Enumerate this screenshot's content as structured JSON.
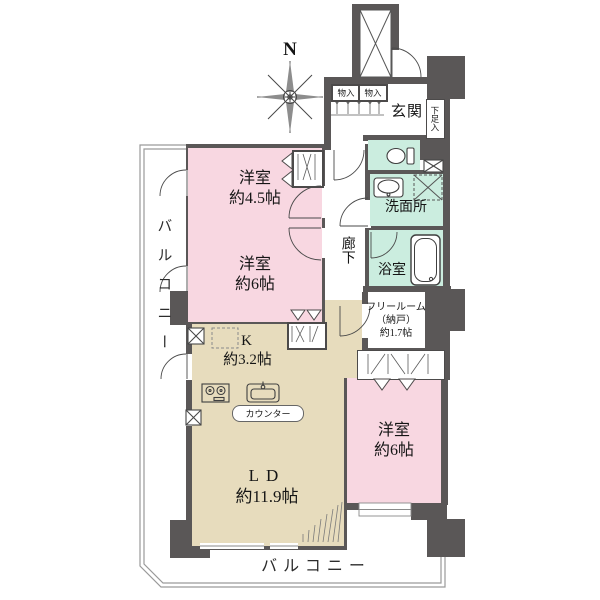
{
  "labels": {
    "north": "N",
    "bedroom1": {
      "name": "洋室",
      "size": "約4.5帖"
    },
    "bedroom2": {
      "name": "洋室",
      "size": "約6帖"
    },
    "bedroom3": {
      "name": "洋室",
      "size": "約6帖"
    },
    "kitchen": {
      "name": "K",
      "size": "約3.2帖"
    },
    "living": {
      "name": "LD",
      "size": "約11.9帖"
    },
    "free_room": {
      "line1": "フリールーム",
      "line2": "（納戸）",
      "line3": "約1.7帖"
    },
    "washroom": "洗面所",
    "bathroom": "浴室",
    "entrance": "玄関",
    "corridor": "廊下",
    "shoe_cupboard": "下足入",
    "storage_left": "物入",
    "storage_right": "物入",
    "counter": "カウンター",
    "balcony_left": "バルコニー",
    "balcony_bottom": "バルコニー"
  },
  "colors": {
    "room_pink": "#f8d7e1",
    "wet_mint": "#cbeddf",
    "ldk_beige": "#e7dcbd",
    "wall_gray": "#5a5757",
    "outline_gray": "#9a9a9a"
  }
}
